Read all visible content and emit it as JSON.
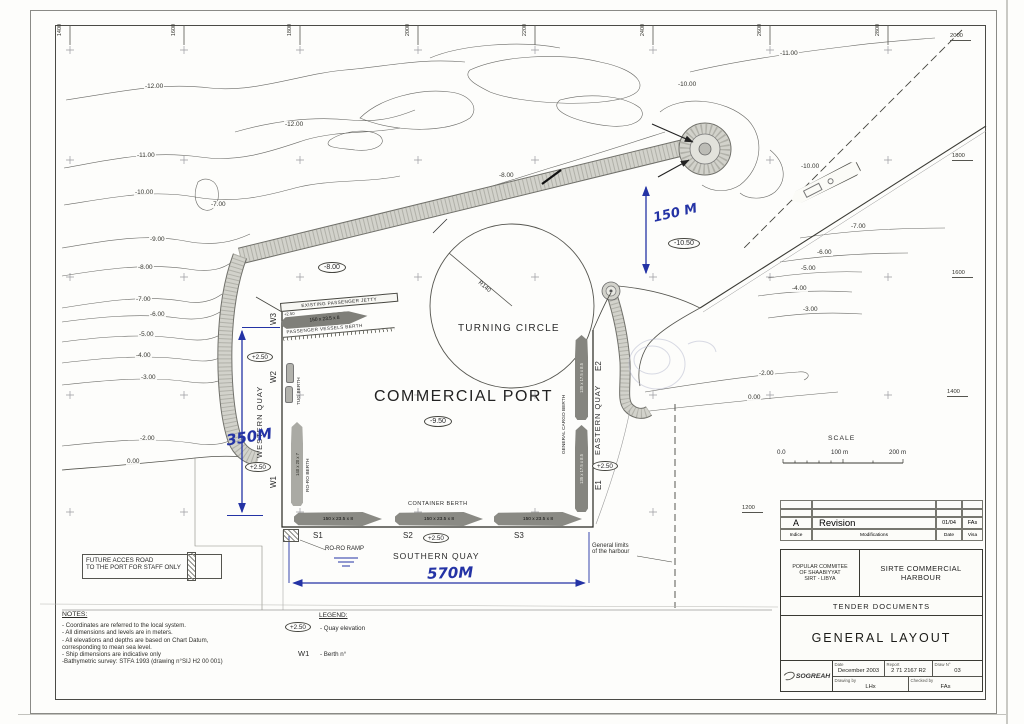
{
  "map": {
    "grid_top": [
      "1400",
      "1600",
      "1800",
      "2000",
      "2200",
      "2400",
      "2600",
      "2800"
    ],
    "grid_right": [
      "2000",
      "1800",
      "1600",
      "1400",
      "1200"
    ],
    "contour_labels": [
      "-12.00",
      "-12.00",
      "-11.00",
      "-10.00",
      "-7.00",
      "-9.00",
      "-8.00",
      "-7.00",
      "-6.00",
      "-5.00",
      "-4.00",
      "-3.00",
      "-2.00",
      "0.00",
      "-11.00",
      "-10.00",
      "-10.00",
      "-8.00",
      "-7.00",
      "-6.00",
      "-5.00",
      "-4.00",
      "-3.00",
      "-2.00",
      "0.00"
    ],
    "depth_west": "-8.00",
    "depth_basin": "-9.50",
    "depth_entrance": "-10.50",
    "port_label": "COMMERCIAL PORT",
    "turning_circle_label": "TURNING CIRCLE",
    "radius_label": "R140",
    "jetty": {
      "label": "EXISTING PASSENGER JETTY",
      "elevation": "+2.50",
      "ship": "150 x 23.5 x 8",
      "berth": "PASSENGER VESSELS BERTH"
    },
    "western_quay": {
      "label": "WESTERN QUAY",
      "w3": "W3",
      "w2": "W2",
      "w1": "W1",
      "elev_top": "+2.50",
      "elev_bottom": "+2.50",
      "tug_berth": "TUG BERTH",
      "roro_berth": "RO-RO BERTH",
      "roro_ship": "140 x 20 x 7"
    },
    "southern_quay": {
      "label": "SOUTHERN QUAY",
      "container_berth": "CONTAINER BERTH",
      "s1": "S1",
      "s2": "S2",
      "s3": "S3",
      "elev": "+2.50",
      "ship1": "150 x 23.5 x 8",
      "ship2": "150 x 23.5 x 8",
      "ship3": "150 x 23.5 x 8",
      "roro_ramp": "RO-RO RAMP"
    },
    "eastern_quay": {
      "label": "EASTERN QUAY",
      "e2": "E2",
      "e1": "E1",
      "elev": "+2.50",
      "cargo_berth": "GENERAL CARGO BERTH",
      "ship1": "135 x 17.5 x 8.5",
      "ship2": "135 x 17.5 x 8.5"
    },
    "dims": {
      "west": "350M",
      "south": "570M",
      "entrance": "150 M"
    },
    "future_road_line1": "FUTURE ACCES ROAD",
    "future_road_line2": "TO THE PORT FOR STAFF ONLY",
    "limits_line1": "General limits",
    "limits_line2": "of the harbour",
    "scale": {
      "title": "SCALE",
      "t0": "0.0",
      "t1": "100 m",
      "t2": "200 m"
    },
    "ink_color": "#2433a5"
  },
  "notes": {
    "title": "NOTES:",
    "lines": [
      "- Coordinates are referred to the local  system.",
      "- All dimensions and levels are in meters.",
      "- All elevations  and depths are based on Chart Datum,",
      "corresponding to  mean sea level.",
      "- Ship dimensions are indicative only",
      "-Bathymetric survey: STFA 1993 (drawing n°SIJ H2 00 001)"
    ]
  },
  "legend": {
    "title": "LEGEND:",
    "elev_symbol": "+2.50",
    "elev_desc": "- Quay elevation",
    "berth_symbol": "W1",
    "berth_desc": "- Berth n°"
  },
  "titleblock": {
    "rev_indice_value": "A",
    "rev_modifications_value": "Revision",
    "rev_date_value": "01/04",
    "rev_visa_value": "FAs",
    "rev_indice_label": "Indice",
    "rev_modifications_label": "Modifications",
    "rev_date_label": "Date",
    "rev_visa_label": "Visa",
    "committee_line1": "POPULAR COMMITEE",
    "committee_line2": "OF SHAABIYYAT",
    "committee_line3": "SIRT - LIBYA",
    "project_line1": "SIRTE COMMERCIAL",
    "project_line2": "HARBOUR",
    "doc_type": "TENDER DOCUMENTS",
    "drawing_title": "GENERAL LAYOUT",
    "logo_text": "SOGREAH",
    "date_label": "Date",
    "date_value": "December 2003",
    "report_label": "Report",
    "report_value": "2 71 2167 R2",
    "draw_label": "Draw N°",
    "draw_value": "03",
    "drawing_by_label": "Drawing by",
    "drawing_by_value": "LHx",
    "checked_by_label": "Checked by",
    "checked_by_value": "FAs"
  }
}
